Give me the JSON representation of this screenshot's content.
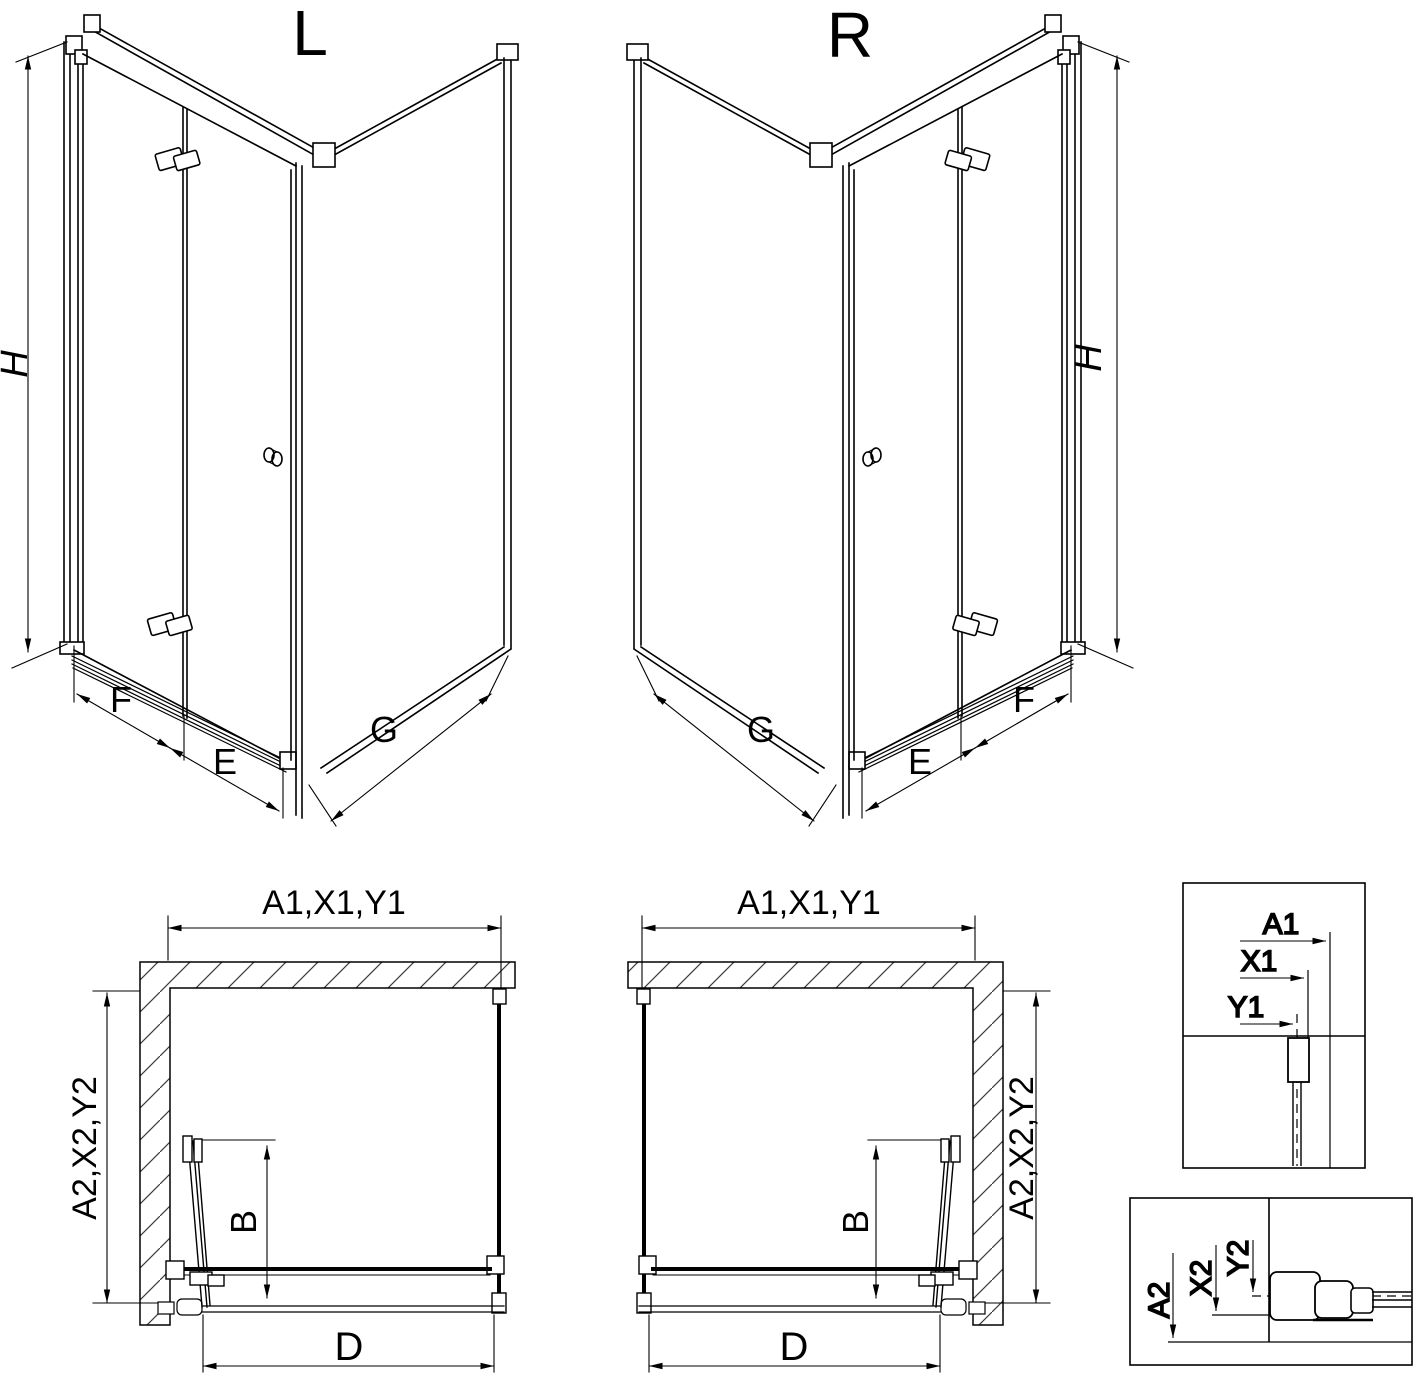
{
  "colors": {
    "line": "#000000",
    "background": "#ffffff",
    "hatch": "#3a3a3a"
  },
  "views": {
    "left": {
      "label": "L",
      "height": "H",
      "door_width": "F",
      "fold_width": "E",
      "side_width": "G"
    },
    "right": {
      "label": "R",
      "height": "H",
      "door_width": "F",
      "fold_width": "E",
      "side_width": "G"
    }
  },
  "plans": {
    "left": {
      "width": "A1,X1,Y1",
      "depth": "A2,X2,Y2",
      "fold_depth": "B",
      "opening": "D"
    },
    "right": {
      "width": "A1,X1,Y1",
      "depth": "A2,X2,Y2",
      "fold_depth": "B",
      "opening": "D"
    }
  },
  "details": {
    "width": {
      "a1": "A1",
      "x1": "X1",
      "y1": "Y1"
    },
    "depth": {
      "a2": "A2",
      "x2": "X2",
      "y2": "Y2"
    }
  }
}
